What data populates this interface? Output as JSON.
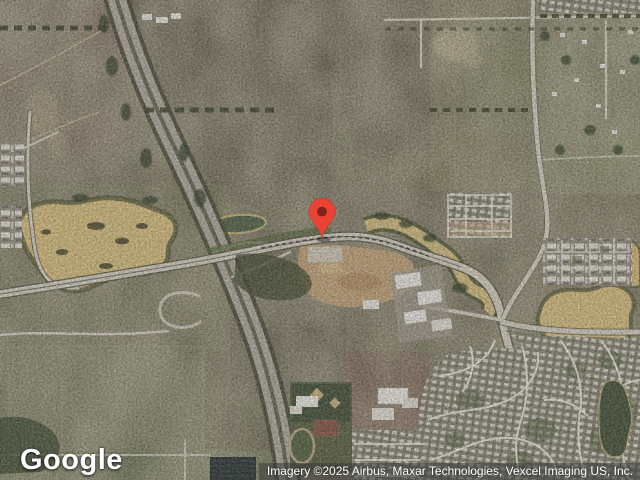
{
  "watermark": {
    "label": "Google"
  },
  "attribution": {
    "text": "Imagery ©2025 Airbus, Maxar Technologies, Vexcel Imaging US, Inc."
  },
  "marker": {
    "color": "#EA4335",
    "dot_color": "#7F231C",
    "transform": "translate(322,238)"
  },
  "palette": {
    "pond_sand": "#D9C183",
    "road_light": "#D7D1C3",
    "highway_gray": "#B3ADA0",
    "field_olive": "#6B644E",
    "field_green": "#75795A",
    "residential_gray": "#98927F",
    "attribution_bg": "rgba(58,58,58,0.55)"
  }
}
